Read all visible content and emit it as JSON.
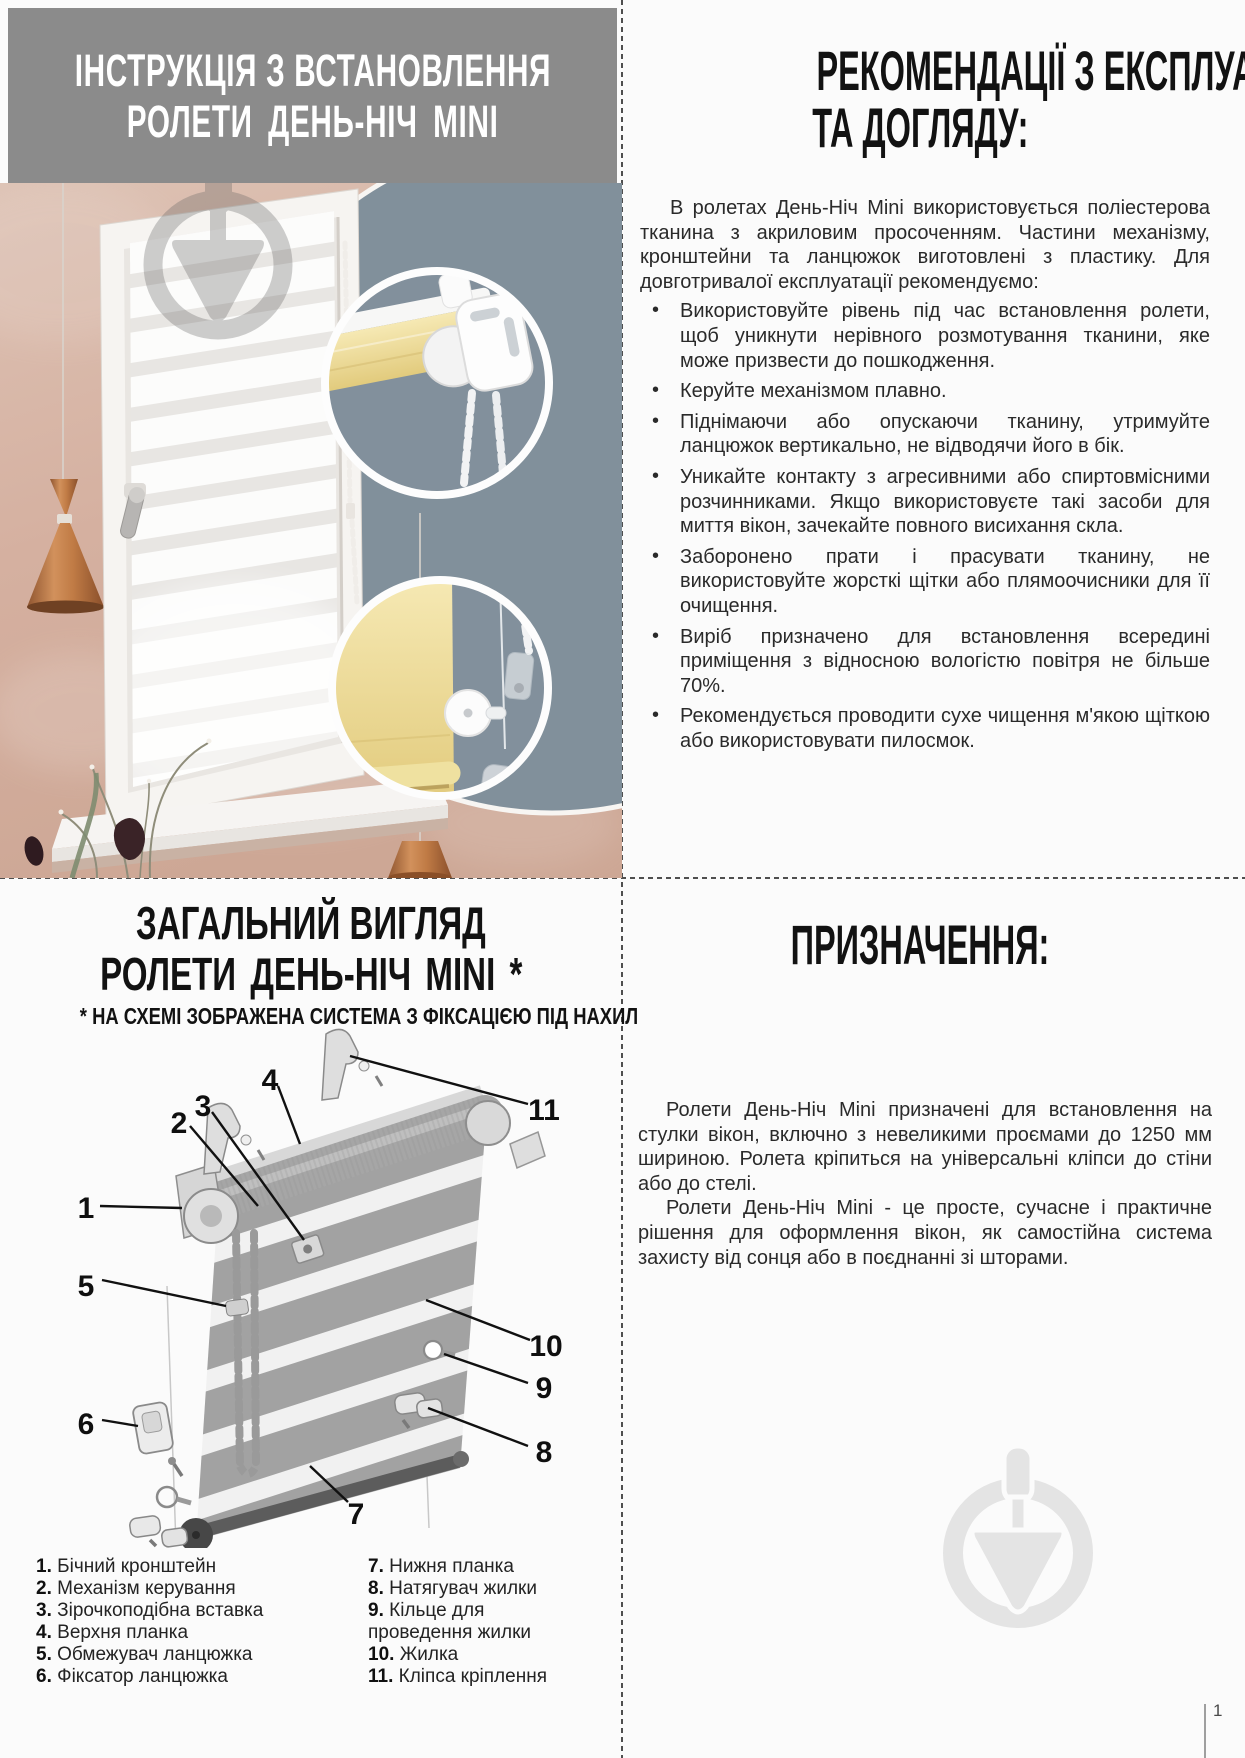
{
  "page": {
    "number": "1"
  },
  "colors": {
    "header_bg": "#8b8b8b",
    "wall_pink": "#d5b0a0",
    "inset_slate": "#82909c",
    "copper_lamp": "#b97c4d",
    "fabric_yellow": "#ecd88f",
    "watermark_gray": "#e4e4e4"
  },
  "install": {
    "title_line1": "ІНСТРУКЦІЯ З ВСТАНОВЛЕННЯ",
    "title_line2": "РОЛЕТИ ДЕНЬ-НІЧ MINI"
  },
  "recommendations": {
    "title_line1": "РЕКОМЕНДАЦІЇ З ЕКСПЛУАТАЦІЇ",
    "title_line2": "ТА ДОГЛЯДУ:",
    "intro": "В ролетах День-Ніч Mini використовується поліестерова тканина з акриловим просоченням. Частини механізму, кронштейни та ланцюжок виготовлені з пластику. Для довготривалої експлуатації рекомендуємо:",
    "bullets": [
      "Використовуйте рівень під час встановлення ролети, щоб уникнути нерівного розмотування тканини, яке може призвести до пошкодження.",
      "Керуйте механізмом плавно.",
      "Піднімаючи або опускаючи тканину, утримуйте ланцюжок вертикально, не відводячи його в бік.",
      "Уникайте контакту з агресивними або спиртовмісними розчинниками. Якщо використовуєте такі засоби для миття вікон, зачекайте повного висихання скла.",
      "Заборонено прати і прасувати тканину, не використовуйте жорсткі щітки або плямоочисники для її очищення.",
      "Виріб призначено для встановлення всередині приміщення з відносною вологістю повітря не більше 70%.",
      "Рекомендується проводити сухе чищення м'якою щіткою або використовувати пилосмок."
    ]
  },
  "overview": {
    "title_line1": "ЗАГАЛЬНИЙ ВИГЛЯД",
    "title_line2": "РОЛЕТИ ДЕНЬ-НІЧ MINI *",
    "note": "* НА СХЕМІ ЗОБРАЖЕНА СИСТЕМА З ФІКСАЦІЄЮ ПІД НАХИЛ",
    "callouts": [
      "1",
      "2",
      "3",
      "4",
      "5",
      "6",
      "7",
      "8",
      "9",
      "10",
      "11"
    ],
    "legend_left": [
      {
        "n": "1.",
        "label": "Бічний кронштейн"
      },
      {
        "n": "2.",
        "label": "Механізм керування"
      },
      {
        "n": "3.",
        "label": "Зірочкоподібна вставка"
      },
      {
        "n": "4.",
        "label": "Верхня планка"
      },
      {
        "n": "5.",
        "label": "Обмежувач ланцюжка"
      },
      {
        "n": "6.",
        "label": "Фіксатор ланцюжка"
      }
    ],
    "legend_right": [
      {
        "n": "7.",
        "label": "Нижня планка"
      },
      {
        "n": "8.",
        "label": "Натягувач жилки"
      },
      {
        "n": "9.",
        "label": "Кільце для проведення жилки"
      },
      {
        "n": "10.",
        "label": "Жилка"
      },
      {
        "n": "11.",
        "label": "Кліпса кріплення"
      }
    ]
  },
  "purpose": {
    "title": "ПРИЗНАЧЕННЯ:",
    "p1": "Ролети День-Ніч Mini призначені для встановлення на стулки вікон, включно з невеликими проємами до 1250 мм шириною. Ролета кріпиться на універсальні кліпси до стіни або до стелі.",
    "p2": "Ролети День-Ніч Mini - це просте, сучасне і практичне рішення для оформлення вікон, як самостійна система захисту від сонця або в поєднанні зі шторами."
  }
}
